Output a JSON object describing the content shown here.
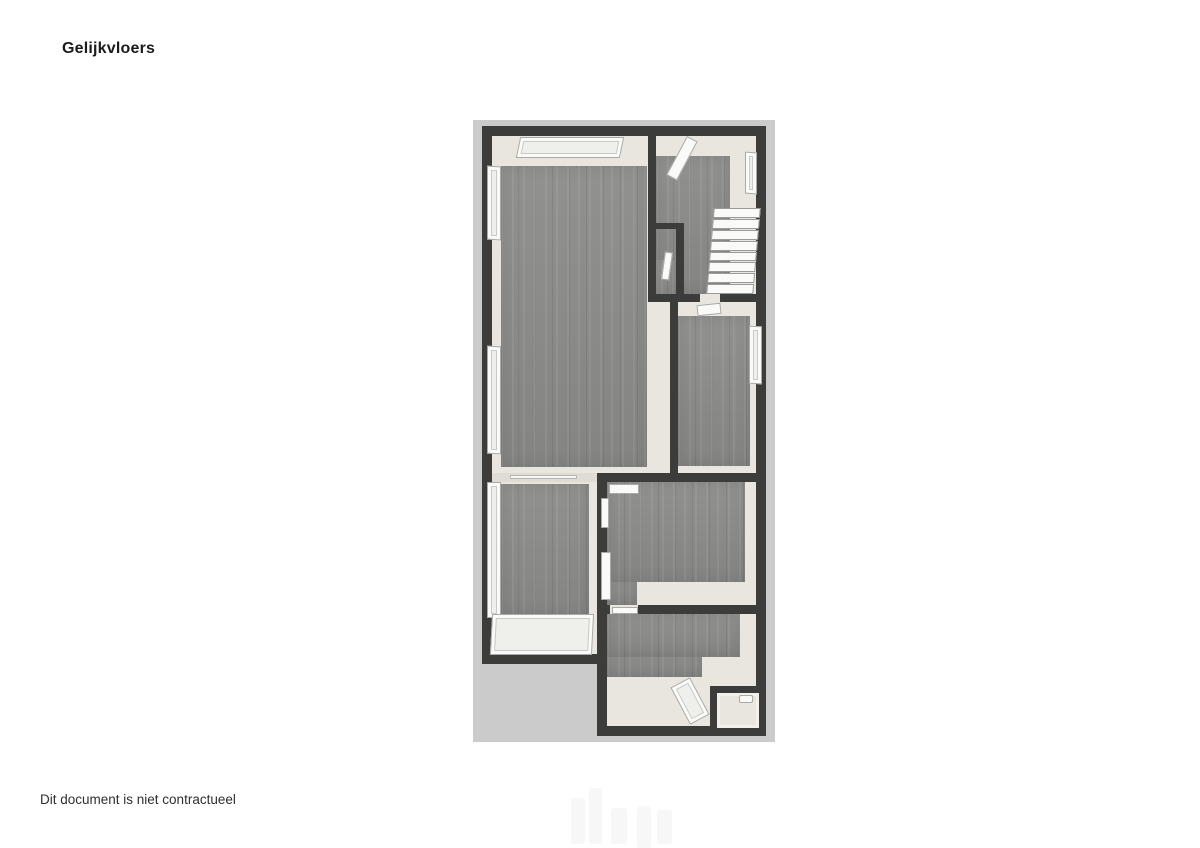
{
  "page": {
    "title": "Gelijkvloers",
    "disclaimer": "Dit document is niet contractueel"
  },
  "floorplan": {
    "name": "ground-floor-plan-3d-top-view",
    "watermark_icon": "faint-logo-watermark",
    "colors": {
      "background": "#cbcbcb",
      "wall": "#3c3c3a",
      "floor_wood": "#8b8b89",
      "wall_base": "#e8e6df",
      "fixture_white": "#fafaf9"
    }
  }
}
